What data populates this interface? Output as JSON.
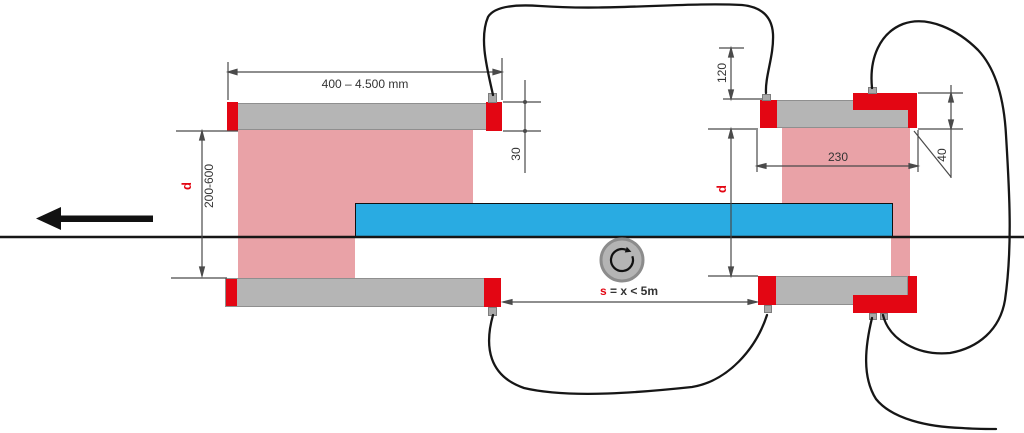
{
  "colors": {
    "accent-red": "#e30613",
    "machine-gray": "#b5b5b5",
    "web-blue": "#29abe2",
    "wrap-pink": "#e9a2a7",
    "line-dark": "#161616",
    "dim-gray": "#4a4a4a",
    "text-dark": "#333333"
  },
  "labels": {
    "top_length": "400 – 4.500 mm",
    "left_diameter_symbol": "d",
    "left_diameter_range": "200-600",
    "left_cap_height": "30",
    "right_offset": "120",
    "right_block_width": "230",
    "right_cap_height": "40",
    "right_diameter_symbol": "d",
    "span_symbol": "s",
    "span_expression": "= x < 5m"
  },
  "icons": {
    "feed_direction": "feed-direction-arrow",
    "rotation_direction": "rotation-direction-arrow"
  }
}
